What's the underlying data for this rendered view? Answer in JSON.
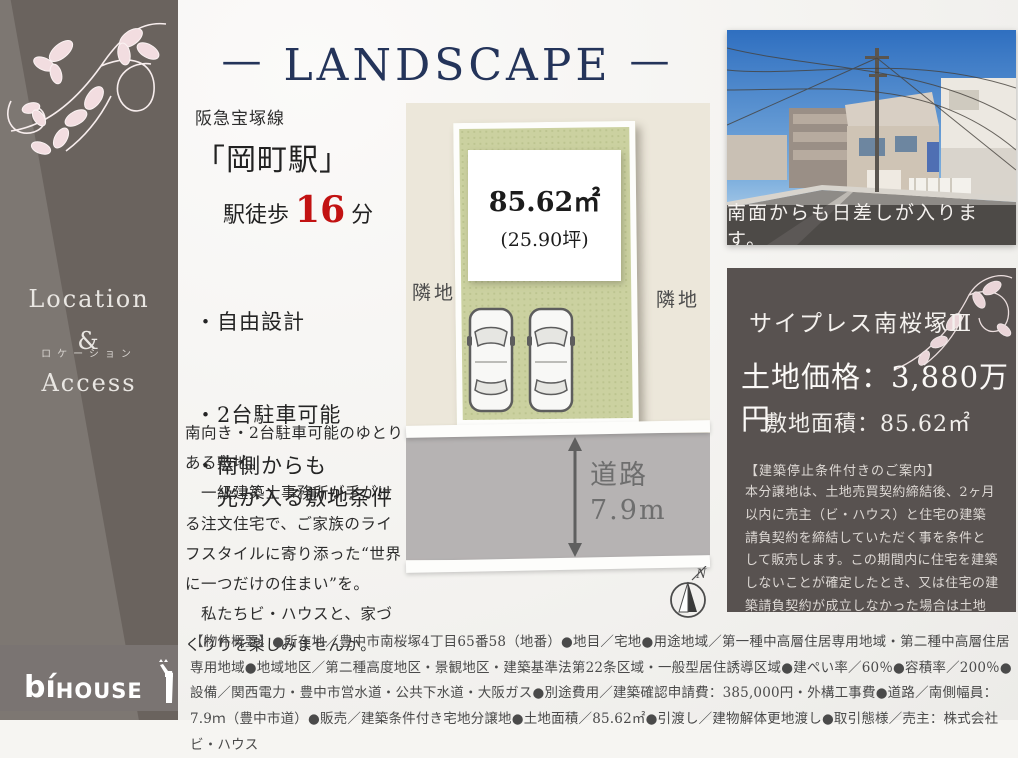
{
  "header": {
    "dash_left": "—",
    "title": "LANDSCAPE",
    "dash_right": "—"
  },
  "sidebar": {
    "heading": [
      "Location",
      "&",
      "Access"
    ],
    "subheading": "ロケーション",
    "logo_bi": "bí",
    "logo_house": "HOUSE",
    "logo_mark": "giraffe"
  },
  "access": {
    "line": "阪急宝塚線",
    "station": "「岡町駅」",
    "walk_label": "駅徒歩",
    "walk_minutes": "16",
    "walk_unit": "分",
    "bullets": [
      "・自由設計",
      "・2台駐車可能",
      "・南側からも\n　光が入る敷地条件"
    ]
  },
  "description": {
    "paragraphs": [
      "南向き・2台駐車可能のゆとりある敷地。",
      "　一級建築士事務所が手がける注文住宅で、ご家族のライフスタイルに寄り添った“世界に一つだけの住まい”を。",
      "　私たちビ・ハウスと、家づくりりを楽しみませんか。"
    ]
  },
  "siteplan": {
    "area_m2": "85.62㎡",
    "area_tsubo": "(25.90坪)",
    "neighbor_left": "隣地",
    "neighbor_right": "隣地",
    "road_label": "道路",
    "road_width": "7.9m",
    "compass_n": "N"
  },
  "photo": {
    "caption": "南面からも日差しが入ります。"
  },
  "offer": {
    "project_name": "サイプレス南桜塚Ⅲ",
    "price_line": "土地価格：3,880万円",
    "area_line": "敷地面積：85.62㎡",
    "notice_title": "【建築停止条件付きのご案内】",
    "notice_body": "本分譲地は、土地売買契約締結後、2ヶ月以内に売主（ビ・ハウス）と住宅の建築請負契約を締結していただく事を条件として販売します。この期間内に住宅を建築しないことが確定したとき、又は住宅の建築請負契約が成立しなかった場合は土地売買契約は白紙となり、受領した金員は無利息でお返しします。"
  },
  "overview": {
    "text": "【物件概要】●所在地／豊中市南桜塚4丁目65番58（地番）●地目／宅地●用途地域／第一種中高層住居専用地域・第二種中高層住居専用地域●地域地区／第二種高度地区・景観地区・建築基準法第22条区域・一般型居住誘導区域●建ぺい率／60％●容積率／200％●設備／関西電力・豊中市営水道・公共下水道・大阪ガス●別途費用／建築確認申請費：385,000円・外構工事費●道路／南側幅員：7.9ｍ（豊中市道）●販売／建築条件付き宅地分譲地●土地面積／85.62㎡●引渡し／建物解体更地渡し●取引態様／売主：株式会社ビ・ハウス"
  },
  "colors": {
    "title_navy": "#24345a",
    "accent_red": "#c21212",
    "sidebar_gray": "#6a635e",
    "offer_box_gray": "#585250",
    "plot_green": "#cbd1a0",
    "road_gray": "#b6b3b3",
    "floral_pink": "#f2dde0"
  }
}
